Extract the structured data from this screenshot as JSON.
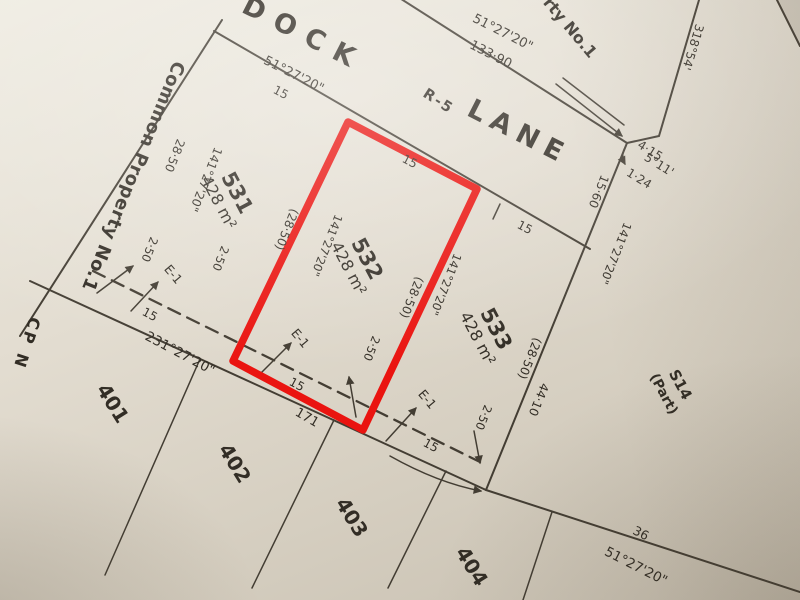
{
  "photo": {
    "kind": "photograph of a cadastral survey / deposited plan with lot 532 outlined in red",
    "paper_color": "#e3ddd1",
    "ink_color": "#433d33"
  },
  "highlight": {
    "lot": "532",
    "color": "#ea1410"
  },
  "road": {
    "dock": "DOCK",
    "classification": "R-5",
    "lane": "LANE"
  },
  "common_property": {
    "left": "Common Property No.1",
    "top_right_fragment": "rty No.1",
    "cp_left_fragment": "CP N"
  },
  "adjoining": {
    "section": "S14",
    "part": "(Part)"
  },
  "easement": {
    "id": "E-1",
    "width": "2·50"
  },
  "lots": [
    {
      "id": "531",
      "area": "428 m²"
    },
    {
      "id": "532",
      "area": "428 m²"
    },
    {
      "id": "533",
      "area": "428 m²"
    },
    {
      "id": "401"
    },
    {
      "id": "402"
    },
    {
      "id": "403"
    },
    {
      "id": "404"
    }
  ],
  "text": {
    "bearing_51": "51°27'20\"",
    "bearing_141": "141°27'20\"",
    "bearing_231": "231°27'20\"",
    "bearing_318": "318°54'",
    "bearing_5_11": "5°11'",
    "d133_90": "133·90",
    "d15": "15",
    "d28_50": "28·50",
    "d28_50_p": "(28·50)",
    "d15_60": "15·60",
    "d44_10": "44·10",
    "d36": "36",
    "d171": "171",
    "d4_15": "4·15",
    "d1_24": "1·24"
  }
}
